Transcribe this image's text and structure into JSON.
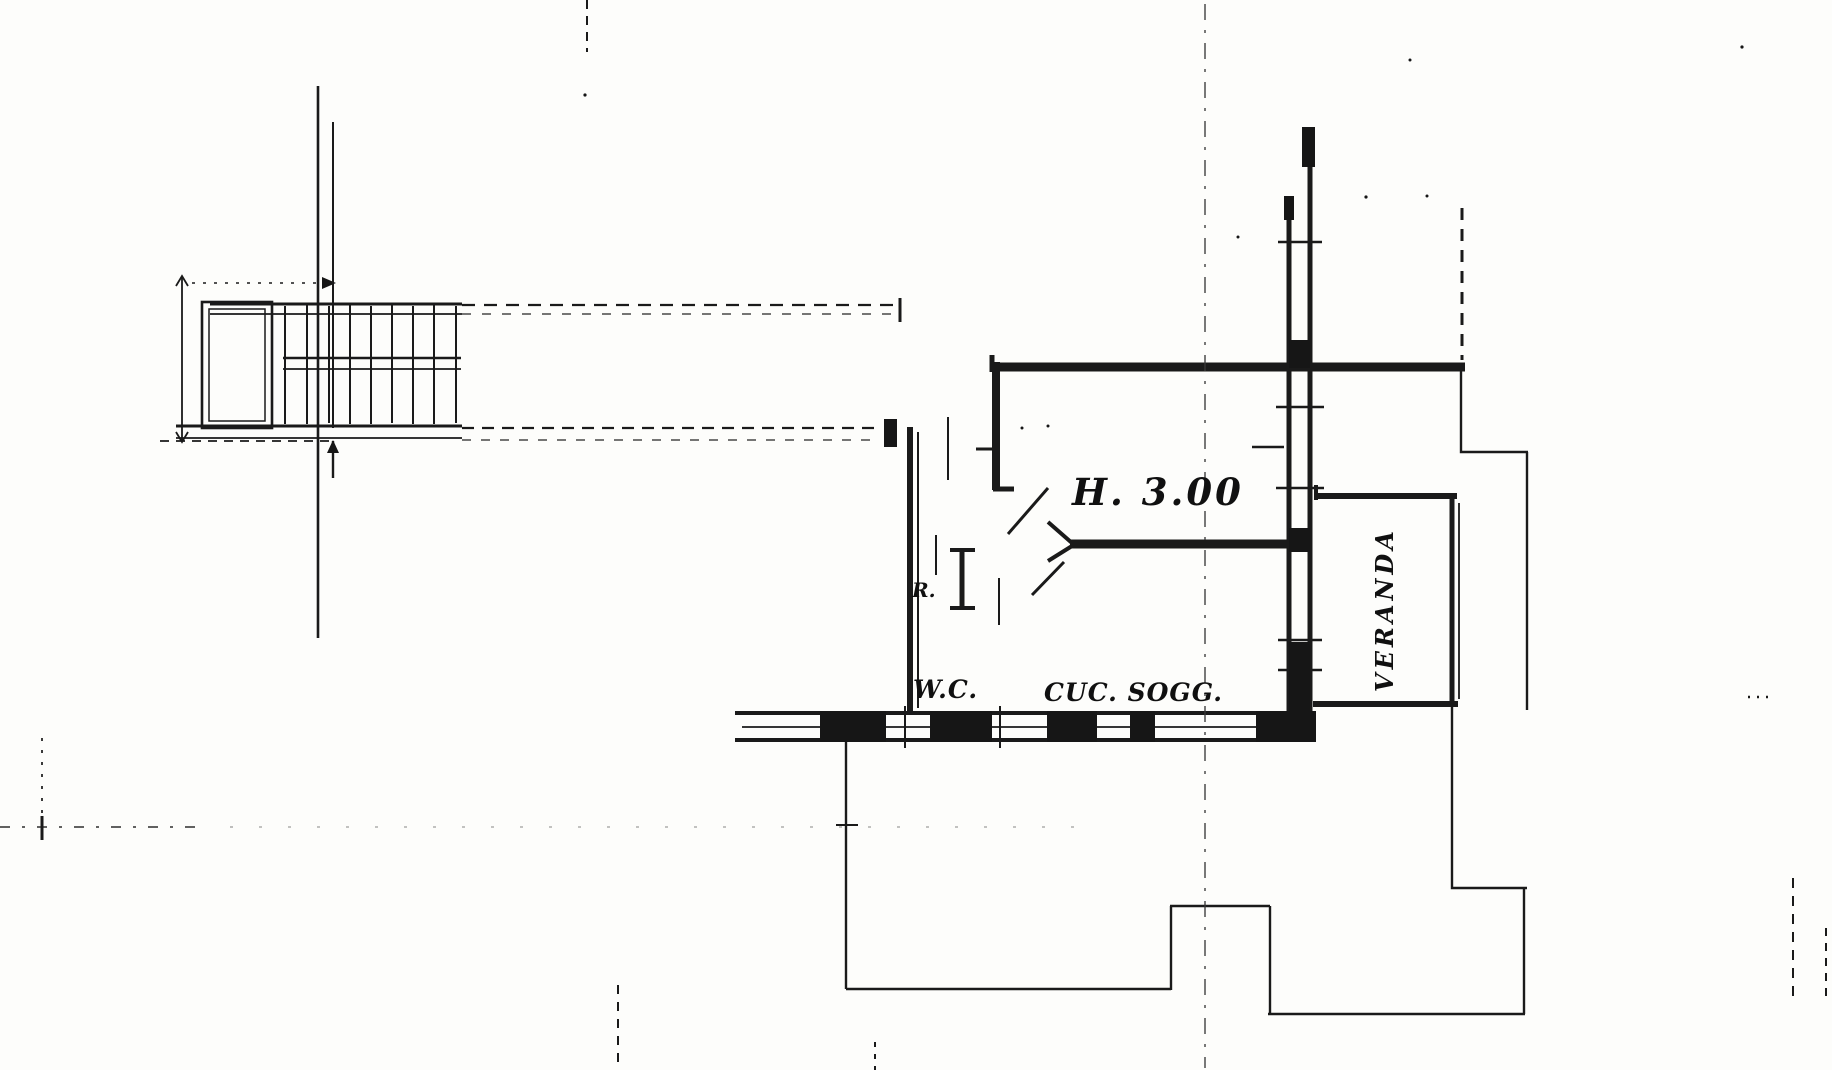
{
  "drawing": {
    "labels": {
      "height_annotation": "H. 3.00",
      "wc_room": "W.C.",
      "kitchen_living_room": "CUC. SOGG.",
      "veranda_room": "VERANDA",
      "reference_mark": "R."
    },
    "colors": {
      "ink": "#1a1a1a",
      "paper": "#fdfdfb"
    }
  }
}
